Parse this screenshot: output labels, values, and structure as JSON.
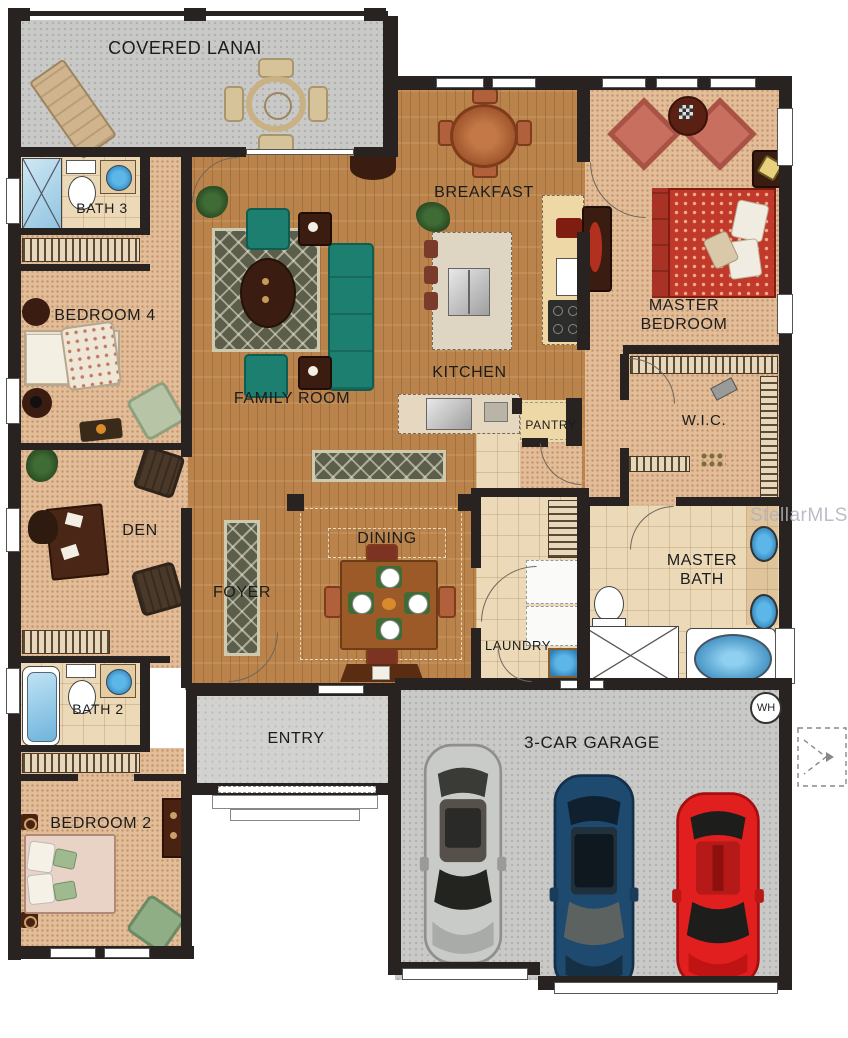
{
  "watermark": "StellarMLS",
  "badges": {
    "water_heater": "WH"
  },
  "rooms": {
    "lanai": {
      "label": "COVERED LANAI"
    },
    "bath3": {
      "label": "BATH 3"
    },
    "bedroom4": {
      "label": "BEDROOM 4"
    },
    "den": {
      "label": "DEN"
    },
    "bath2": {
      "label": "BATH 2"
    },
    "bedroom2": {
      "label": "BEDROOM 2"
    },
    "family_room": {
      "label": "FAMILY ROOM"
    },
    "breakfast": {
      "label": "BREAKFAST"
    },
    "kitchen": {
      "label": "KITCHEN"
    },
    "pantry": {
      "label": "PANTRY"
    },
    "master_bedroom": {
      "label": "MASTER\nBEDROOM"
    },
    "wic": {
      "label": "W.I.C."
    },
    "master_bath": {
      "label": "MASTER\nBATH"
    },
    "laundry": {
      "label": "LAUNDRY"
    },
    "dining": {
      "label": "DINING"
    },
    "foyer": {
      "label": "FOYER"
    },
    "entry": {
      "label": "ENTRY"
    },
    "garage": {
      "label": "3-CAR GARAGE"
    }
  },
  "colors": {
    "wall": "#282220",
    "wood_floor": "#b9834b",
    "carpet": "#e2bd98",
    "tile": "#ecd9b8",
    "concrete": "#c9c9c7",
    "sofa_teal": "#1d7f70",
    "bed_red": "#c0392b",
    "accent_salmon": "#c96f60",
    "car_silver": "#c9cbc9",
    "car_blue": "#1e4a70",
    "car_red": "#e21f1f",
    "fixture_blue": "#5db6e8"
  }
}
